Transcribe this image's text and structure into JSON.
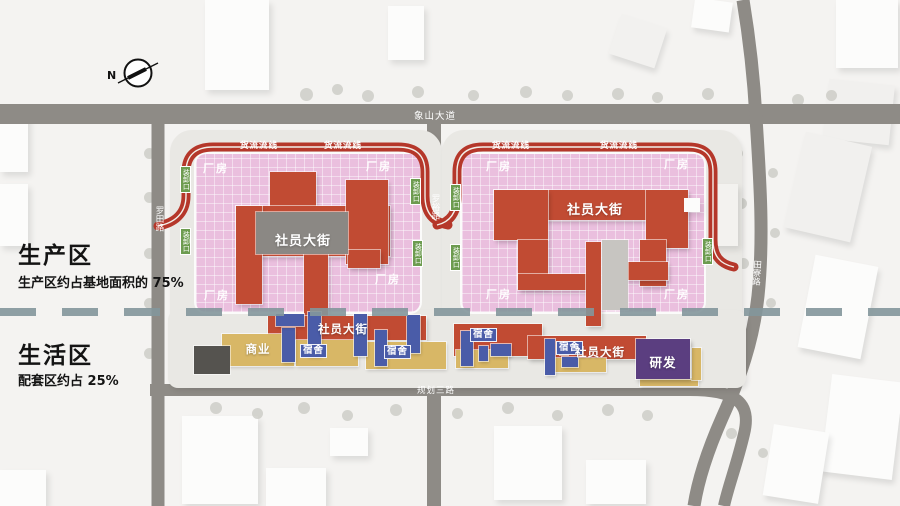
{
  "compass": {
    "label": "N"
  },
  "legend": {
    "production_title": "生产区",
    "production_subtitle": "生产区约占基地面积的 75%",
    "living_title": "生活区",
    "living_subtitle": "配套区约占 25%"
  },
  "roads": {
    "top": "象山大道",
    "left": "罗田路",
    "middle": "罗裕路",
    "right": "田寮路",
    "bottom": "规划三路"
  },
  "blocks": {
    "left": {
      "street": "社员大街",
      "factory_nw": "厂房",
      "factory_ne": "厂房",
      "factory_sw": "厂房",
      "factory_se": "厂房",
      "logistics_1": "货流流线",
      "logistics_2": "货流流线",
      "dock_1": "装卸口",
      "dock_2": "装卸口",
      "dock_3": "装卸口",
      "dock_4": "装卸口"
    },
    "right": {
      "street": "社员大街",
      "factory_nw": "厂房",
      "factory_ne": "厂房",
      "factory_sw": "厂房",
      "factory_se": "厂房",
      "logistics_1": "货流流线",
      "logistics_2": "货流流线",
      "dock_1": "装卸口",
      "dock_2": "装卸口",
      "dock_3": "装卸口"
    }
  },
  "living": {
    "street_1": "社员大街",
    "street_2": "社员大街",
    "commercial": "商业",
    "dorm_1": "宿舍",
    "dorm_2": "宿舍",
    "dorm_3": "宿舍",
    "dorm_4": "宿舍",
    "rnd": "研发"
  },
  "colors": {
    "factory_pink": "#eabfde",
    "street_red": "#c14b33",
    "ring_red": "#b5372a",
    "dorm_blue": "#4a5ca8",
    "commercial_yellow": "#d8b766",
    "rnd_purple": "#5b3e80",
    "dock_green": "#6d9c50",
    "road_gray": "#8e8b86",
    "divider_teal": "#84979c"
  }
}
